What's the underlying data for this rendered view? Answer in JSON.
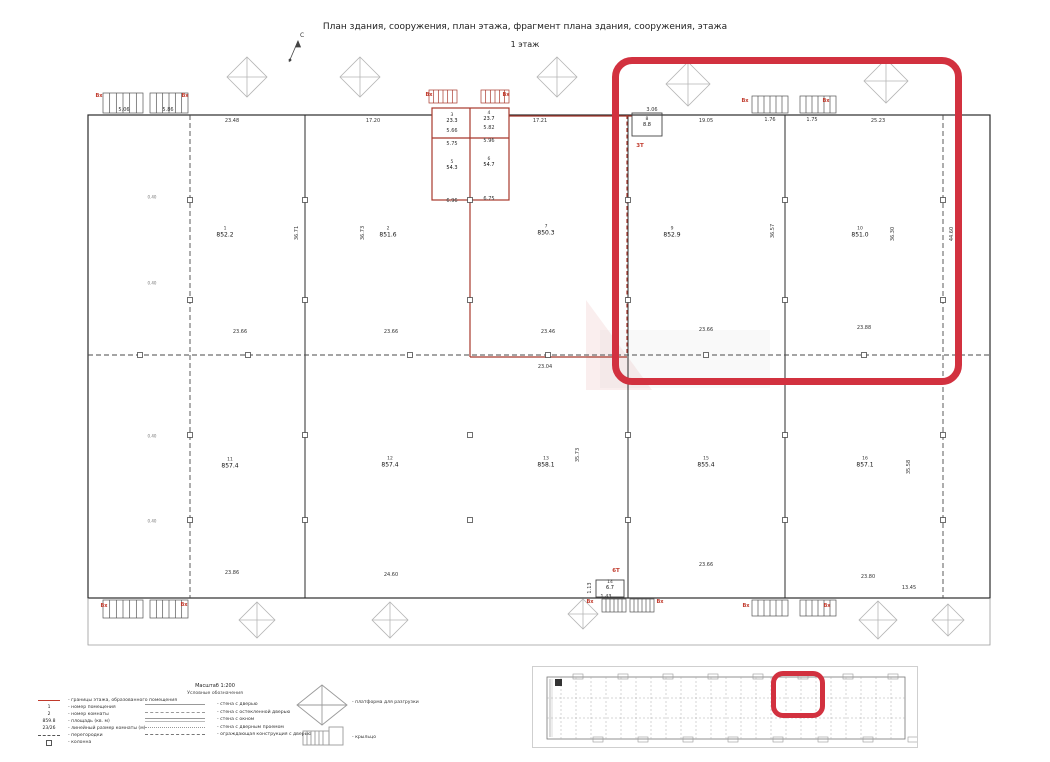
{
  "title": "План здания, сооружения, план этажа, фрагмент плана здания, сооружения, этажа",
  "subtitle": "1 этаж",
  "north_label": "С",
  "accent_red": "#d2313f",
  "fragment_red": "#a8382c",
  "plan": {
    "rooms": [
      {
        "num": "1",
        "area": "852.2",
        "x": 225,
        "y": 233,
        "small": false
      },
      {
        "num": "2",
        "area": "851.6",
        "x": 388,
        "y": 233,
        "small": false
      },
      {
        "num": "3",
        "area": "23.3",
        "x": 452,
        "y": 119,
        "small": true
      },
      {
        "num": "4",
        "area": "23.7",
        "x": 489,
        "y": 117,
        "small": true
      },
      {
        "num": "5",
        "area": "54.3",
        "x": 452,
        "y": 166,
        "small": true
      },
      {
        "num": "6",
        "area": "54.7",
        "x": 489,
        "y": 163,
        "small": true
      },
      {
        "num": "7",
        "area": "850.3",
        "x": 546,
        "y": 231,
        "small": false
      },
      {
        "num": "8",
        "area": "8.8",
        "x": 647,
        "y": 123,
        "small": true
      },
      {
        "num": "9",
        "area": "852.9",
        "x": 672,
        "y": 233,
        "small": false
      },
      {
        "num": "10",
        "area": "851.0",
        "x": 860,
        "y": 233,
        "small": false
      },
      {
        "num": "11",
        "area": "857.4",
        "x": 230,
        "y": 464,
        "small": false
      },
      {
        "num": "12",
        "area": "857.4",
        "x": 390,
        "y": 463,
        "small": false
      },
      {
        "num": "13",
        "area": "858.1",
        "x": 546,
        "y": 463,
        "small": false
      },
      {
        "num": "14",
        "area": "6.7",
        "x": 610,
        "y": 586,
        "small": true
      },
      {
        "num": "15",
        "area": "855.4",
        "x": 706,
        "y": 463,
        "small": false
      },
      {
        "num": "16",
        "area": "857.1",
        "x": 865,
        "y": 463,
        "small": false
      }
    ],
    "dims": [
      {
        "t": "23.48",
        "x": 232,
        "y": 121
      },
      {
        "t": "17.20",
        "x": 373,
        "y": 121
      },
      {
        "t": "17.21",
        "x": 540,
        "y": 121
      },
      {
        "t": "19.05",
        "x": 706,
        "y": 121
      },
      {
        "t": "25.23",
        "x": 878,
        "y": 121
      },
      {
        "t": "23.66",
        "x": 240,
        "y": 332
      },
      {
        "t": "23.66",
        "x": 391,
        "y": 332
      },
      {
        "t": "23.46",
        "x": 548,
        "y": 332
      },
      {
        "t": "23.66",
        "x": 706,
        "y": 330
      },
      {
        "t": "23.88",
        "x": 864,
        "y": 328
      },
      {
        "t": "23.04",
        "x": 545,
        "y": 367
      },
      {
        "t": "23.86",
        "x": 232,
        "y": 573
      },
      {
        "t": "24.60",
        "x": 391,
        "y": 575
      },
      {
        "t": "23.66",
        "x": 706,
        "y": 565
      },
      {
        "t": "23.80",
        "x": 868,
        "y": 577
      },
      {
        "t": "13.45",
        "x": 909,
        "y": 588
      },
      {
        "t": "36.71",
        "x": 297,
        "y": 233,
        "r": 1
      },
      {
        "t": "36.73",
        "x": 363,
        "y": 233,
        "r": 1
      },
      {
        "t": "36.57",
        "x": 617,
        "y": 232,
        "r": 1
      },
      {
        "t": "36.57",
        "x": 773,
        "y": 231,
        "r": 1
      },
      {
        "t": "36.30",
        "x": 893,
        "y": 234,
        "r": 1
      },
      {
        "t": "44.60",
        "x": 952,
        "y": 234,
        "r": 1
      },
      {
        "t": "35.73",
        "x": 578,
        "y": 455,
        "r": 1
      },
      {
        "t": "35.58",
        "x": 909,
        "y": 467,
        "r": 1
      },
      {
        "t": "5.66",
        "x": 452,
        "y": 131
      },
      {
        "t": "5.82",
        "x": 489,
        "y": 128
      },
      {
        "t": "5.75",
        "x": 452,
        "y": 144
      },
      {
        "t": "5.96",
        "x": 489,
        "y": 141
      },
      {
        "t": "6.96",
        "x": 452,
        "y": 201
      },
      {
        "t": "6.75",
        "x": 489,
        "y": 199
      },
      {
        "t": "3.06",
        "x": 652,
        "y": 110
      },
      {
        "t": "1.76",
        "x": 770,
        "y": 120
      },
      {
        "t": "1.75",
        "x": 812,
        "y": 120
      },
      {
        "t": "1.43",
        "x": 606,
        "y": 597
      },
      {
        "t": "1.13",
        "x": 590,
        "y": 588,
        "r": 1
      },
      {
        "t": "5.06",
        "x": 124,
        "y": 110
      },
      {
        "t": "5.86",
        "x": 168,
        "y": 110
      },
      {
        "t": "0.40",
        "x": 152,
        "y": 197,
        "tiny": 1
      },
      {
        "t": "0.40",
        "x": 152,
        "y": 283,
        "tiny": 1
      },
      {
        "t": "0.40",
        "x": 152,
        "y": 436,
        "tiny": 1
      },
      {
        "t": "0.40",
        "x": 152,
        "y": 521,
        "tiny": 1
      }
    ],
    "entrances": [
      {
        "t": "Вх",
        "x": 99,
        "y": 96
      },
      {
        "t": "Вх",
        "x": 185,
        "y": 96
      },
      {
        "t": "Вх",
        "x": 429,
        "y": 95
      },
      {
        "t": "Вх",
        "x": 506,
        "y": 95
      },
      {
        "t": "Вх",
        "x": 745,
        "y": 101
      },
      {
        "t": "Вх",
        "x": 826,
        "y": 101
      },
      {
        "t": "Вх",
        "x": 104,
        "y": 606
      },
      {
        "t": "Вх",
        "x": 184,
        "y": 605
      },
      {
        "t": "Вх",
        "x": 590,
        "y": 602
      },
      {
        "t": "Вх",
        "x": 660,
        "y": 602
      },
      {
        "t": "Вх",
        "x": 746,
        "y": 606
      },
      {
        "t": "Вх",
        "x": 827,
        "y": 606
      }
    ],
    "tech_labels": [
      {
        "t": "3Т",
        "x": 640,
        "y": 146
      },
      {
        "t": "6Т",
        "x": 616,
        "y": 571
      }
    ]
  },
  "legend": {
    "scale": "Масштаб 1:200",
    "legend_title": "Условные обозначения",
    "left_symbols": {
      "num": "1",
      "num2": "2",
      "area": "859.8",
      "size": "23/26"
    },
    "left_items": [
      "- границы этажа, образованного помещения",
      "- номер помещения",
      "- номер комнаты",
      "- площадь (кв. м)",
      "- линейный размер комнаты (м)",
      "- перегородки",
      "- колонна"
    ],
    "wall_items": [
      "- стена с дверью",
      "- стена с остекленной дверью",
      "- стена с окном",
      "- стена с дверным проемом",
      "- ограждающая конструкция с дверью"
    ],
    "platform_label": "- платформа для разгрузки",
    "porch_label": "- крыльцо"
  }
}
